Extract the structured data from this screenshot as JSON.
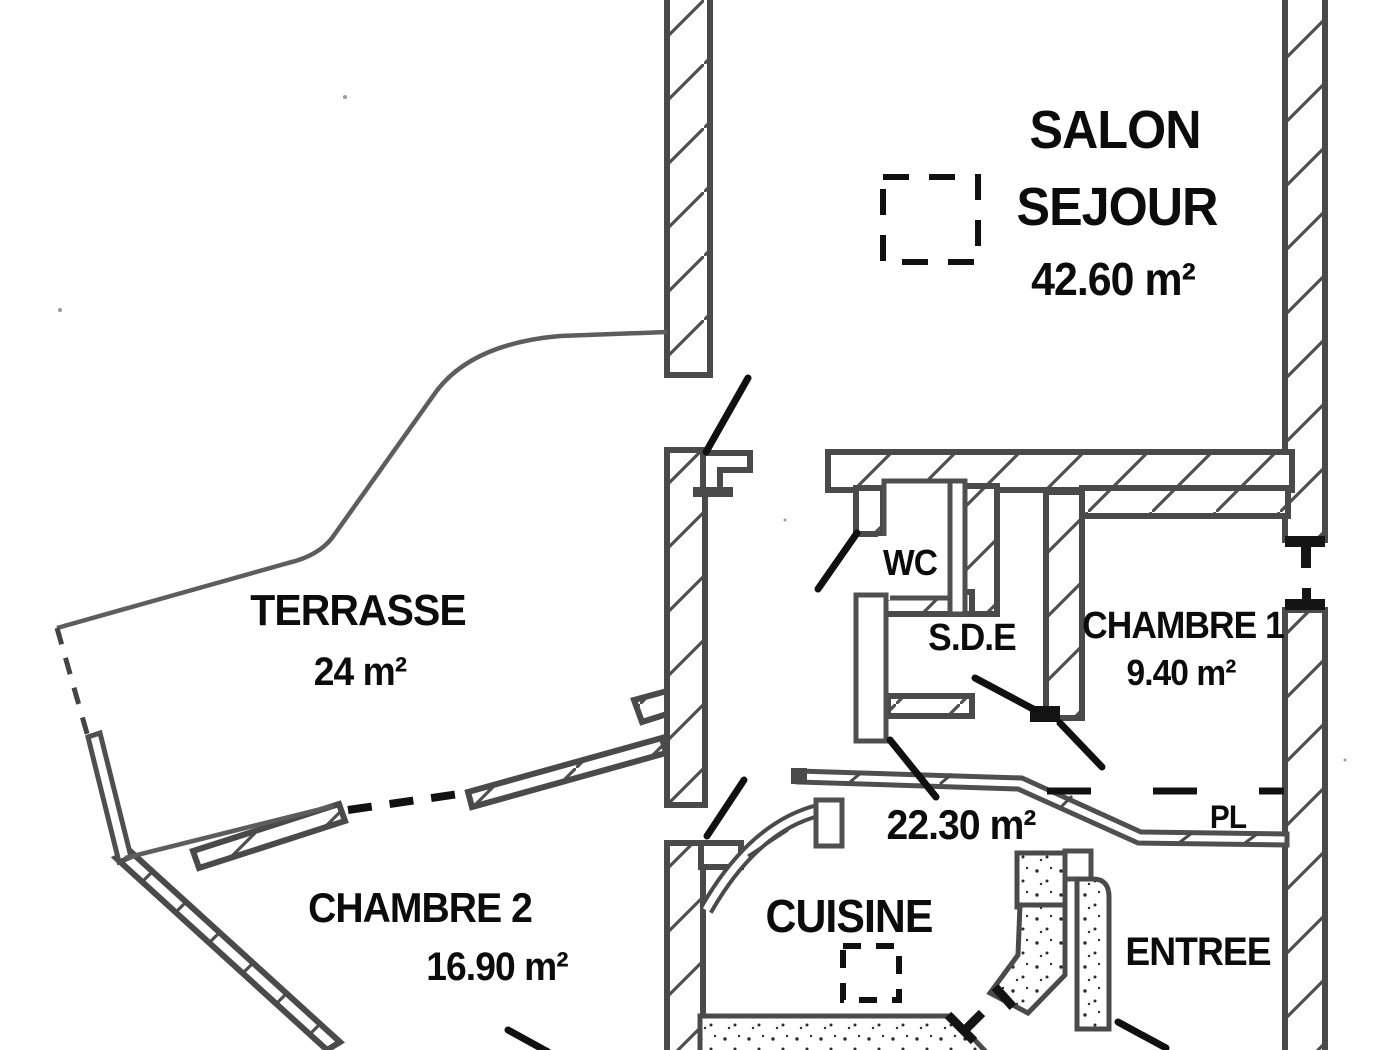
{
  "plan_title": "floor-plan",
  "colors": {
    "wall_line": "#4a4a4a",
    "thin_line": "#5d5d5d",
    "ink": "#0c0c0c",
    "background": "#ffffff"
  },
  "rooms": {
    "salon_sejour": {
      "label_line1": "SALON",
      "label_line2": "SEJOUR",
      "area": "42.60 m²"
    },
    "terrasse": {
      "label": "TERRASSE",
      "area": "24 m²"
    },
    "wc": {
      "label": "WC"
    },
    "sde": {
      "label": "S.D.E"
    },
    "chambre1": {
      "label": "CHAMBRE 1",
      "area": "9.40 m²"
    },
    "placard": {
      "label": "PL"
    },
    "cuisine": {
      "label": "CUISINE",
      "area": "22.30 m²"
    },
    "chambre2": {
      "label": "CHAMBRE 2",
      "area": "16.90 m²"
    },
    "entree": {
      "label": "ENTREE"
    }
  }
}
